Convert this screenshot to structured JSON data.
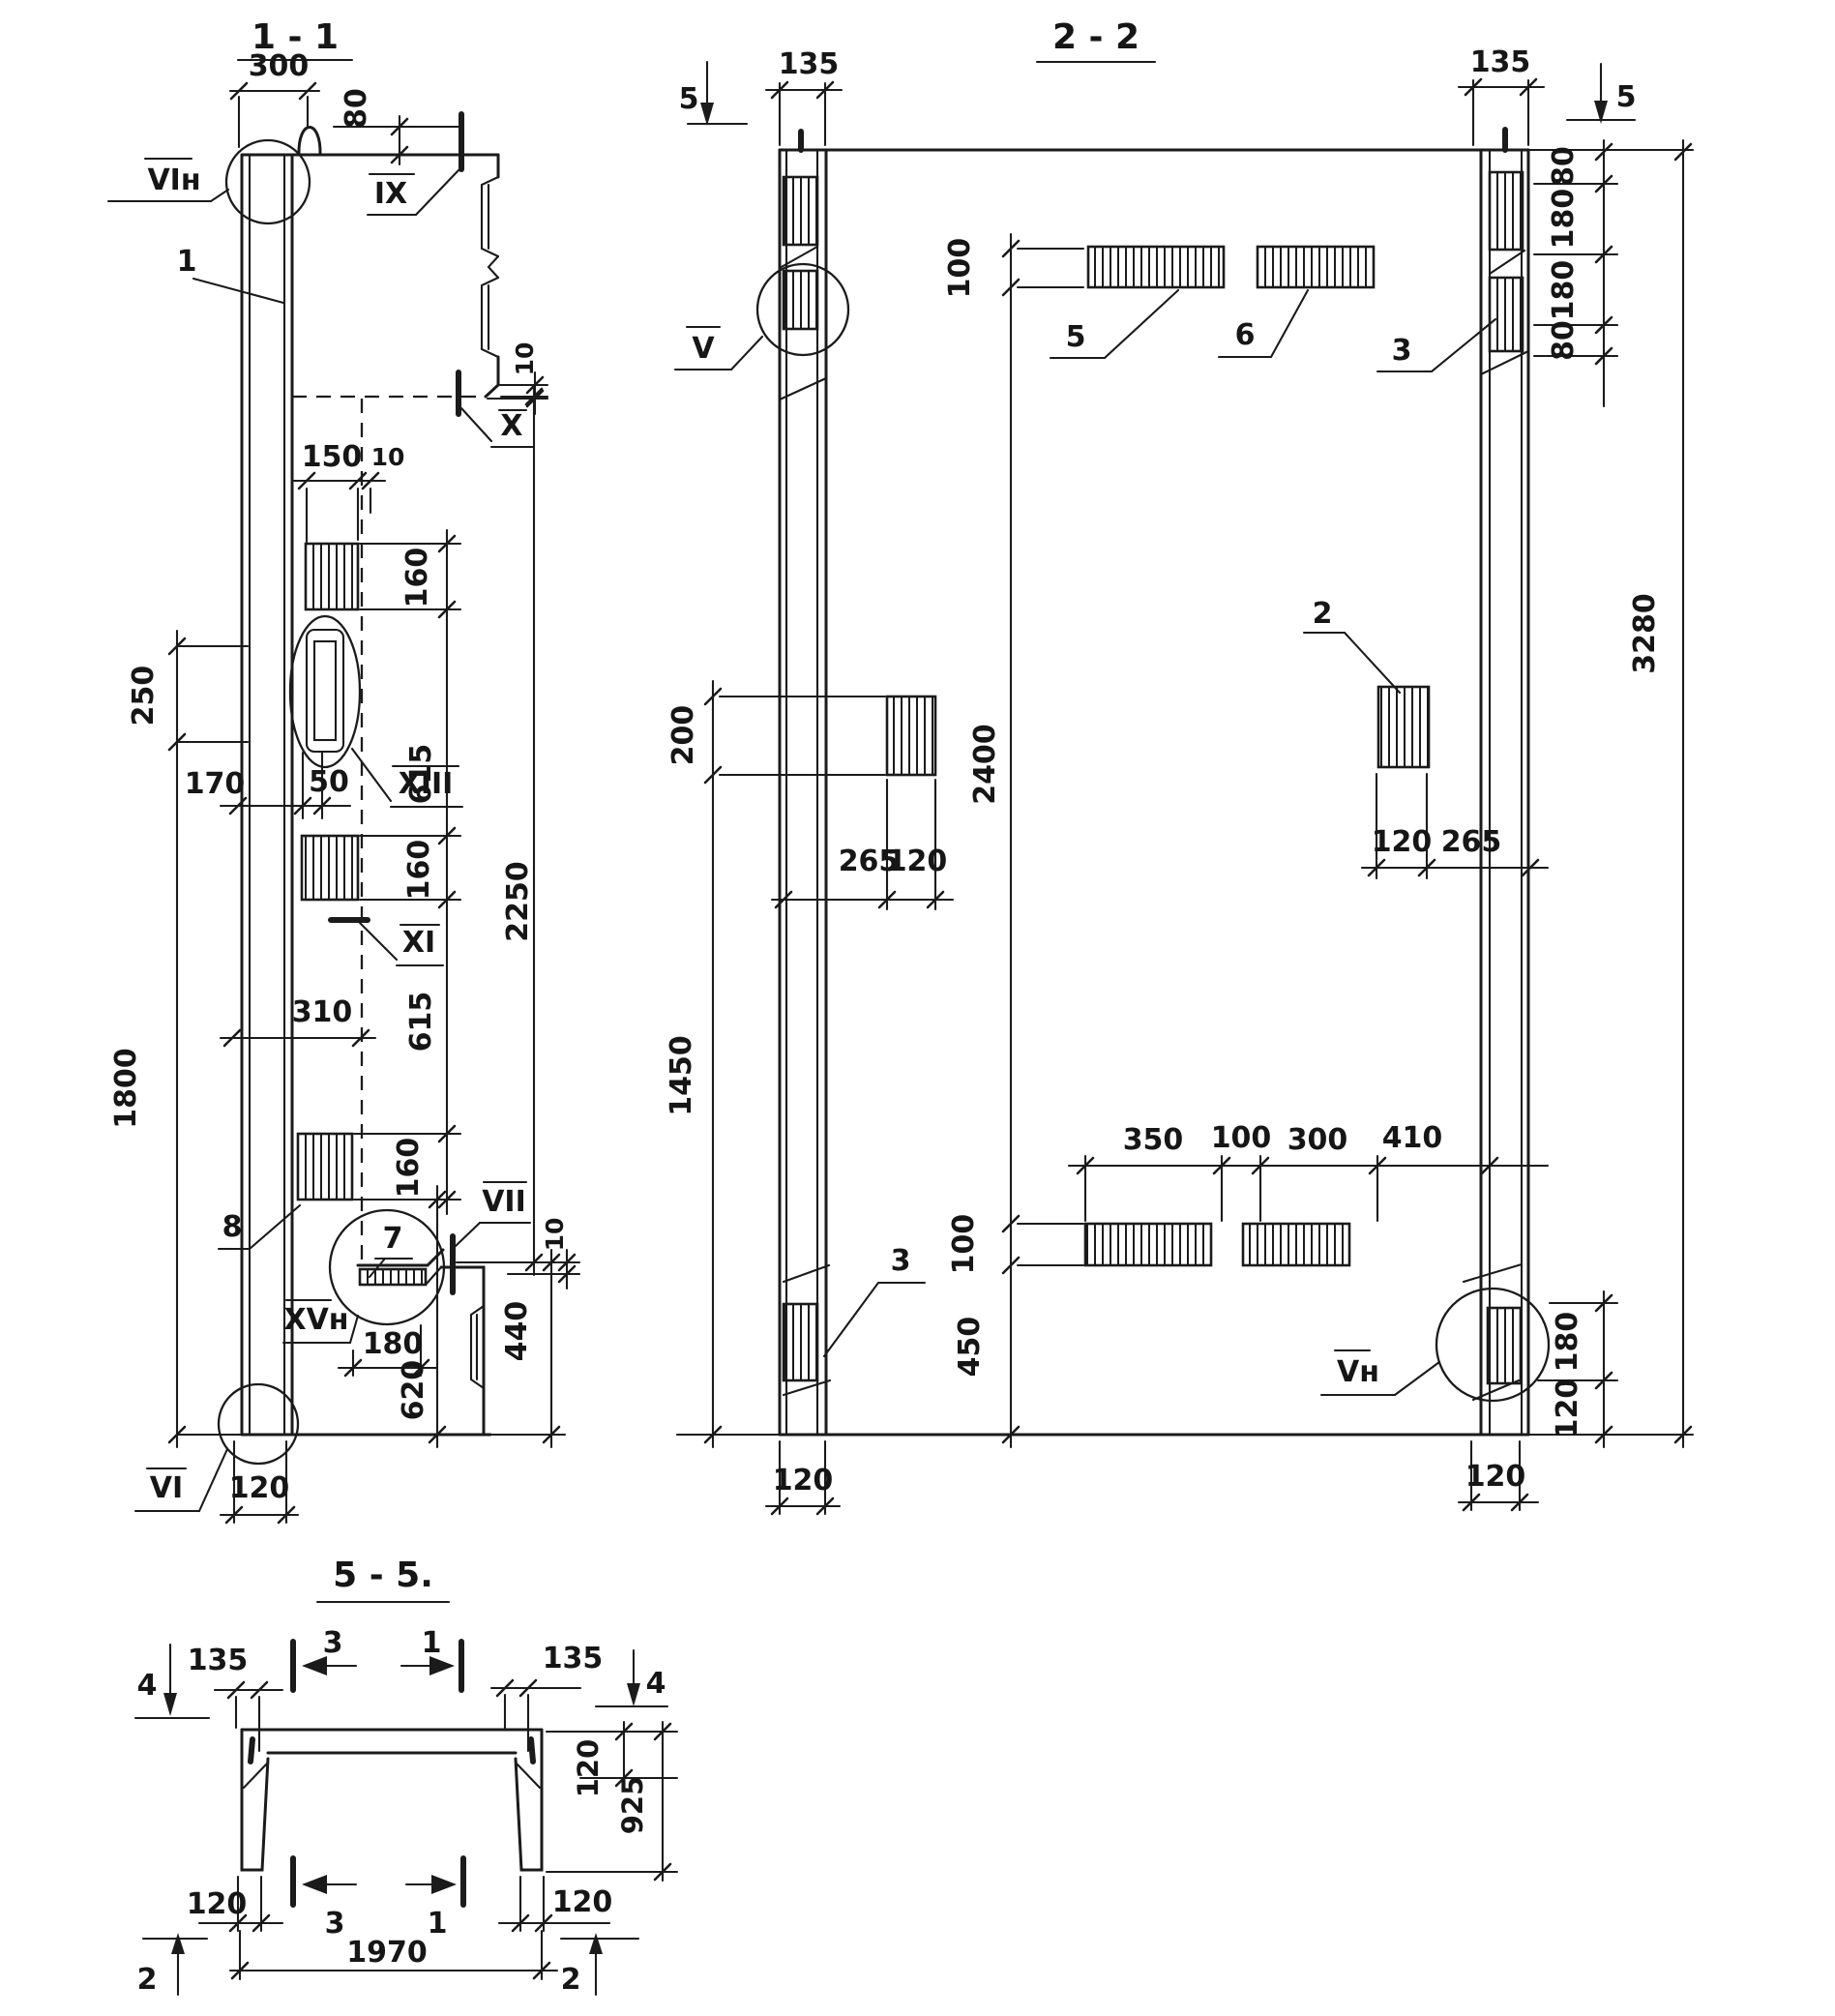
{
  "s11": {
    "title": "1 - 1",
    "labels": {
      "vin": "VIн",
      "n1": "1",
      "ix": "IX",
      "x": "X",
      "xiii": "XIII",
      "xi": "XI",
      "n8": "8",
      "n7": "7",
      "vii": "VII",
      "xvn": "XVн",
      "vi": "VI"
    },
    "dims": {
      "d300": "300",
      "d80": "80",
      "d10a": "10",
      "d150": "150",
      "d10b": "10",
      "d160a": "160",
      "d615a": "615",
      "d160b": "160",
      "d615b": "615",
      "d160c": "160",
      "d2250": "2250",
      "d250": "250",
      "d170": "170",
      "d50": "50",
      "d310": "310",
      "d1800": "1800",
      "d120": "120",
      "d180": "180",
      "d620": "620",
      "d440": "440",
      "d10c": "10"
    }
  },
  "s22": {
    "title": "2 - 2",
    "labels": {
      "v": "V",
      "vn": "Vн",
      "n2": "2",
      "n3t": "3",
      "n3b": "3",
      "n5": "5",
      "n6": "6"
    },
    "markers": {
      "m5l": "5",
      "m5r": "5"
    },
    "dims": {
      "d135l": "135",
      "d135r": "135",
      "d100t": "100",
      "d80a": "80",
      "d180a": "180",
      "d180b": "180",
      "d80b": "80",
      "d3280": "3280",
      "d200": "200",
      "d1450": "1450",
      "d2400": "2400",
      "d265l": "265",
      "d120l": "120",
      "d120r": "120",
      "d265r": "265",
      "d350": "350",
      "d100m": "100",
      "d300": "300",
      "d410": "410",
      "d100b": "100",
      "d450": "450",
      "d180c": "180",
      "d120c": "120",
      "d120bl": "120",
      "d120br": "120"
    }
  },
  "s55": {
    "title": "5 - 5.",
    "markers": {
      "m4l": "4",
      "m4r": "4",
      "m3t": "3",
      "m1t": "1",
      "m3b": "3",
      "m1b": "1",
      "m2l": "2",
      "m2r": "2"
    },
    "dims": {
      "d135l": "135",
      "d135r": "135",
      "d120t": "120",
      "d925": "925",
      "d120bl": "120",
      "d1970": "1970",
      "d120br": "120"
    }
  }
}
